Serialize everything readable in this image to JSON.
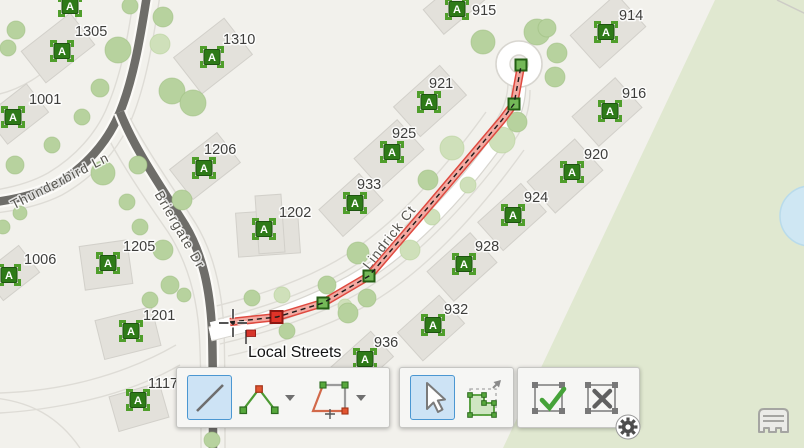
{
  "map": {
    "marker_letter": "A",
    "tooltip_label": "Local Streets",
    "street_labels": {
      "thunderbird": "Thunderbird Ln",
      "briergate": "Briergate Dr",
      "lindrick": "Lindrick Ct"
    },
    "parcel_labels": [
      "1305",
      "1310",
      "1001",
      "915",
      "914",
      "921",
      "916",
      "925",
      "1206",
      "920",
      "933",
      "924",
      "1202",
      "928",
      "1205",
      "1006",
      "932",
      "1201",
      "936",
      "1117"
    ],
    "colors": {
      "marker_green": "#2e7a18",
      "marker_bracket_green": "#4f9e2b",
      "sketch_edge_red": "#df4a40",
      "sketch_fill_pink": "#f2a9a1",
      "vertex_green": "#74b858",
      "active_vertex_red": "#e03328",
      "selected_tool_fill": "#cde3f5",
      "selected_tool_border": "#4b97d2",
      "greenbelt": "#e0e8d0",
      "road": "#6e6d69",
      "water": "#cfe7f3"
    }
  },
  "toolbar": {
    "draw_group": {
      "line_tool_icon": "line-tool-icon",
      "polyline_tool_icon": "polyline-tool-icon",
      "polygon_tool_icon": "polygon-tool-icon",
      "dropdown_icon": "chevron-down-icon",
      "selected_tool": "line"
    },
    "select_group": {
      "select_tool_icon": "select-pointer-icon",
      "reshape_tool_icon": "reshape-tool-icon",
      "selected_tool": "select"
    },
    "action_group": {
      "finish_icon": "finish-sketch-check-icon",
      "cancel_icon": "cancel-sketch-x-icon"
    },
    "settings_icon": "gear-icon",
    "corner_icon": "building-icon"
  }
}
